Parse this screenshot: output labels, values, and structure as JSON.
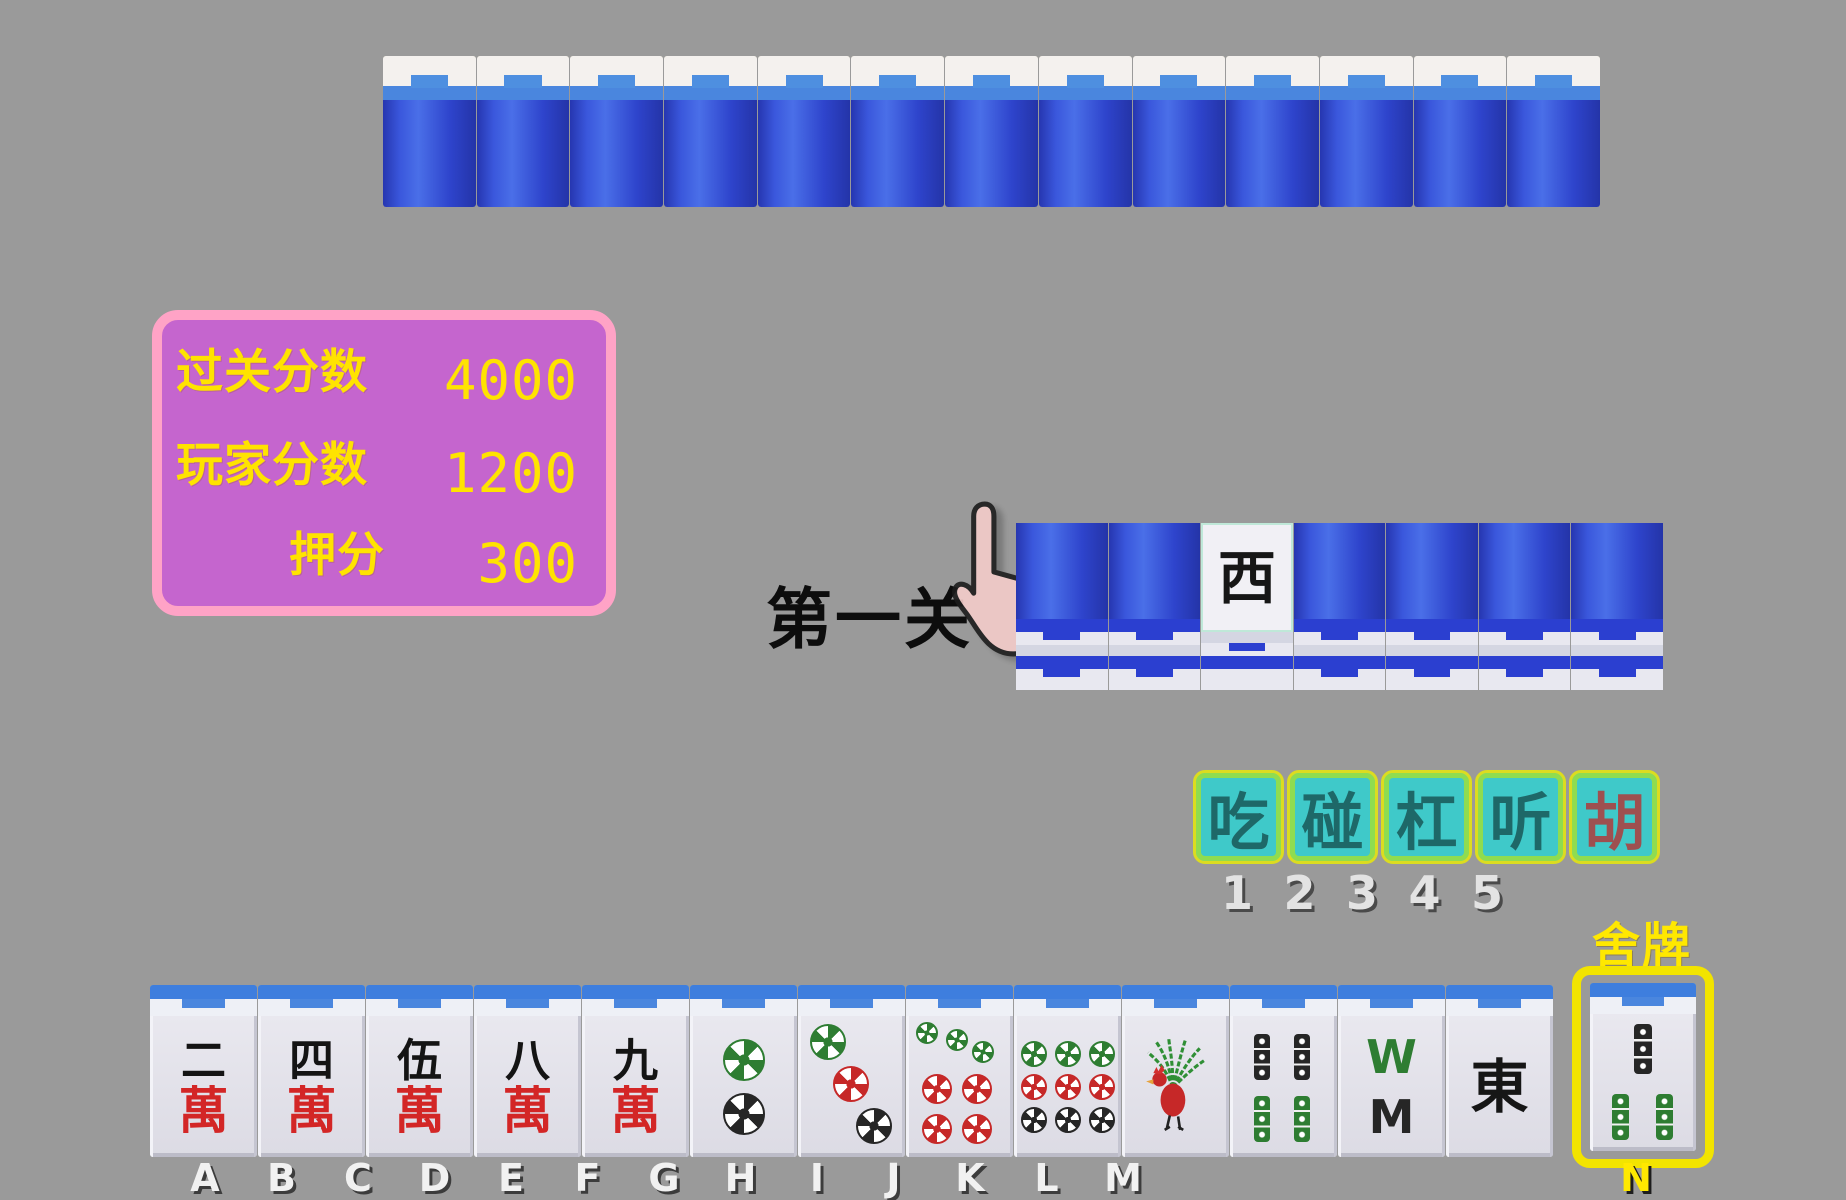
{
  "colors": {
    "bg": "#9a9a9a",
    "panel_fill": "#c565ce",
    "panel_border": "#ffa3c6",
    "panel_text": "#ffe300",
    "button_fill": "#3fc9c9",
    "button_inner": "#8fdc50",
    "button_outer": "#dcdc20",
    "button_text": "#1e6868",
    "hu_text": "#9e5050",
    "highlight": "#ffe800",
    "tile_back_blue": "#2b3fd0",
    "dot_green": "#2e7d32",
    "dot_red": "#c62828",
    "dot_black": "#262626"
  },
  "level_label": "第一关",
  "top_wall": {
    "count": 13
  },
  "score_panel": {
    "rows": [
      {
        "label": "过关分数",
        "value": "4000"
      },
      {
        "label": "玩家分数",
        "value": "1200"
      },
      {
        "label": "押分",
        "value": "300"
      }
    ]
  },
  "middle_row": {
    "tiles": [
      {
        "name": "face-down-tile",
        "face": "back"
      },
      {
        "name": "face-down-tile",
        "face": "back"
      },
      {
        "name": "west-wind-tile",
        "face": "wind:西"
      },
      {
        "name": "face-down-tile",
        "face": "back"
      },
      {
        "name": "face-down-tile",
        "face": "back"
      },
      {
        "name": "face-down-tile",
        "face": "back"
      },
      {
        "name": "face-down-tile",
        "face": "back"
      }
    ]
  },
  "action_bar": {
    "buttons": [
      {
        "label": "吃",
        "key": "1",
        "accent": false
      },
      {
        "label": "碰",
        "key": "2",
        "accent": false
      },
      {
        "label": "杠",
        "key": "3",
        "accent": false
      },
      {
        "label": "听",
        "key": "4",
        "accent": false
      },
      {
        "label": "胡",
        "key": "5",
        "accent": true
      }
    ]
  },
  "discard": {
    "title": "舍牌",
    "slot_label": "N",
    "tile": {
      "name": "3-bamboo",
      "face": "bamboo:3"
    }
  },
  "hand": {
    "tiles": [
      {
        "slot": "A",
        "name": "2-wan",
        "face": "wan:二"
      },
      {
        "slot": "B",
        "name": "4-wan",
        "face": "wan:四"
      },
      {
        "slot": "C",
        "name": "5-wan",
        "face": "wan:伍"
      },
      {
        "slot": "D",
        "name": "8-wan",
        "face": "wan:八"
      },
      {
        "slot": "E",
        "name": "9-wan",
        "face": "wan:九"
      },
      {
        "slot": "F",
        "name": "2-dots",
        "face": "dots:2"
      },
      {
        "slot": "G",
        "name": "3-dots",
        "face": "dots:3"
      },
      {
        "slot": "H",
        "name": "7-dots",
        "face": "dots:7"
      },
      {
        "slot": "I",
        "name": "9-dots",
        "face": "dots:9"
      },
      {
        "slot": "J",
        "name": "1-bamboo-bird",
        "face": "bird:1"
      },
      {
        "slot": "K",
        "name": "4-bamboo",
        "face": "bamboo:4"
      },
      {
        "slot": "L",
        "name": "8-bamboo",
        "face": "bamboo:8"
      },
      {
        "slot": "M",
        "name": "east-wind",
        "face": "wind:東"
      }
    ]
  }
}
